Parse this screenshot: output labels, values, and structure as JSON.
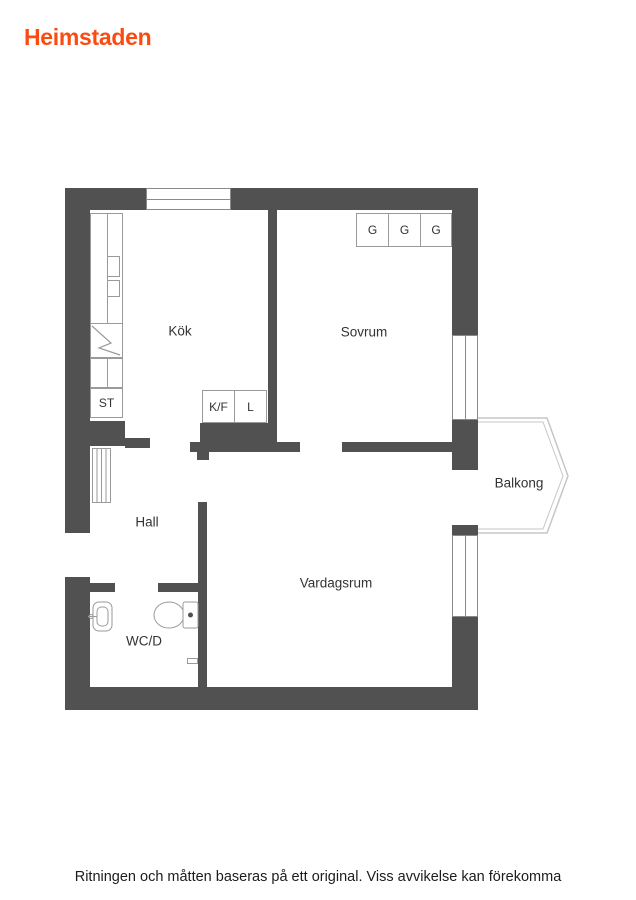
{
  "brand": {
    "name": "Heimstaden",
    "color": "#fb4b10"
  },
  "plan": {
    "wall_color": "#515151",
    "rooms": {
      "kitchen": "Kök",
      "bedroom": "Sovrum",
      "hall": "Hall",
      "bathroom": "WC/D",
      "living_room": "Vardagsrum",
      "balcony": "Balkong"
    },
    "fixtures": {
      "cleaning_closet": "ST",
      "fridge_freezer": "K/F",
      "pantry": "L",
      "wardrobe": "G"
    }
  },
  "footer": {
    "disclaimer": "Ritningen och måtten baseras på ett original. Viss avvikelse kan förekomma"
  }
}
